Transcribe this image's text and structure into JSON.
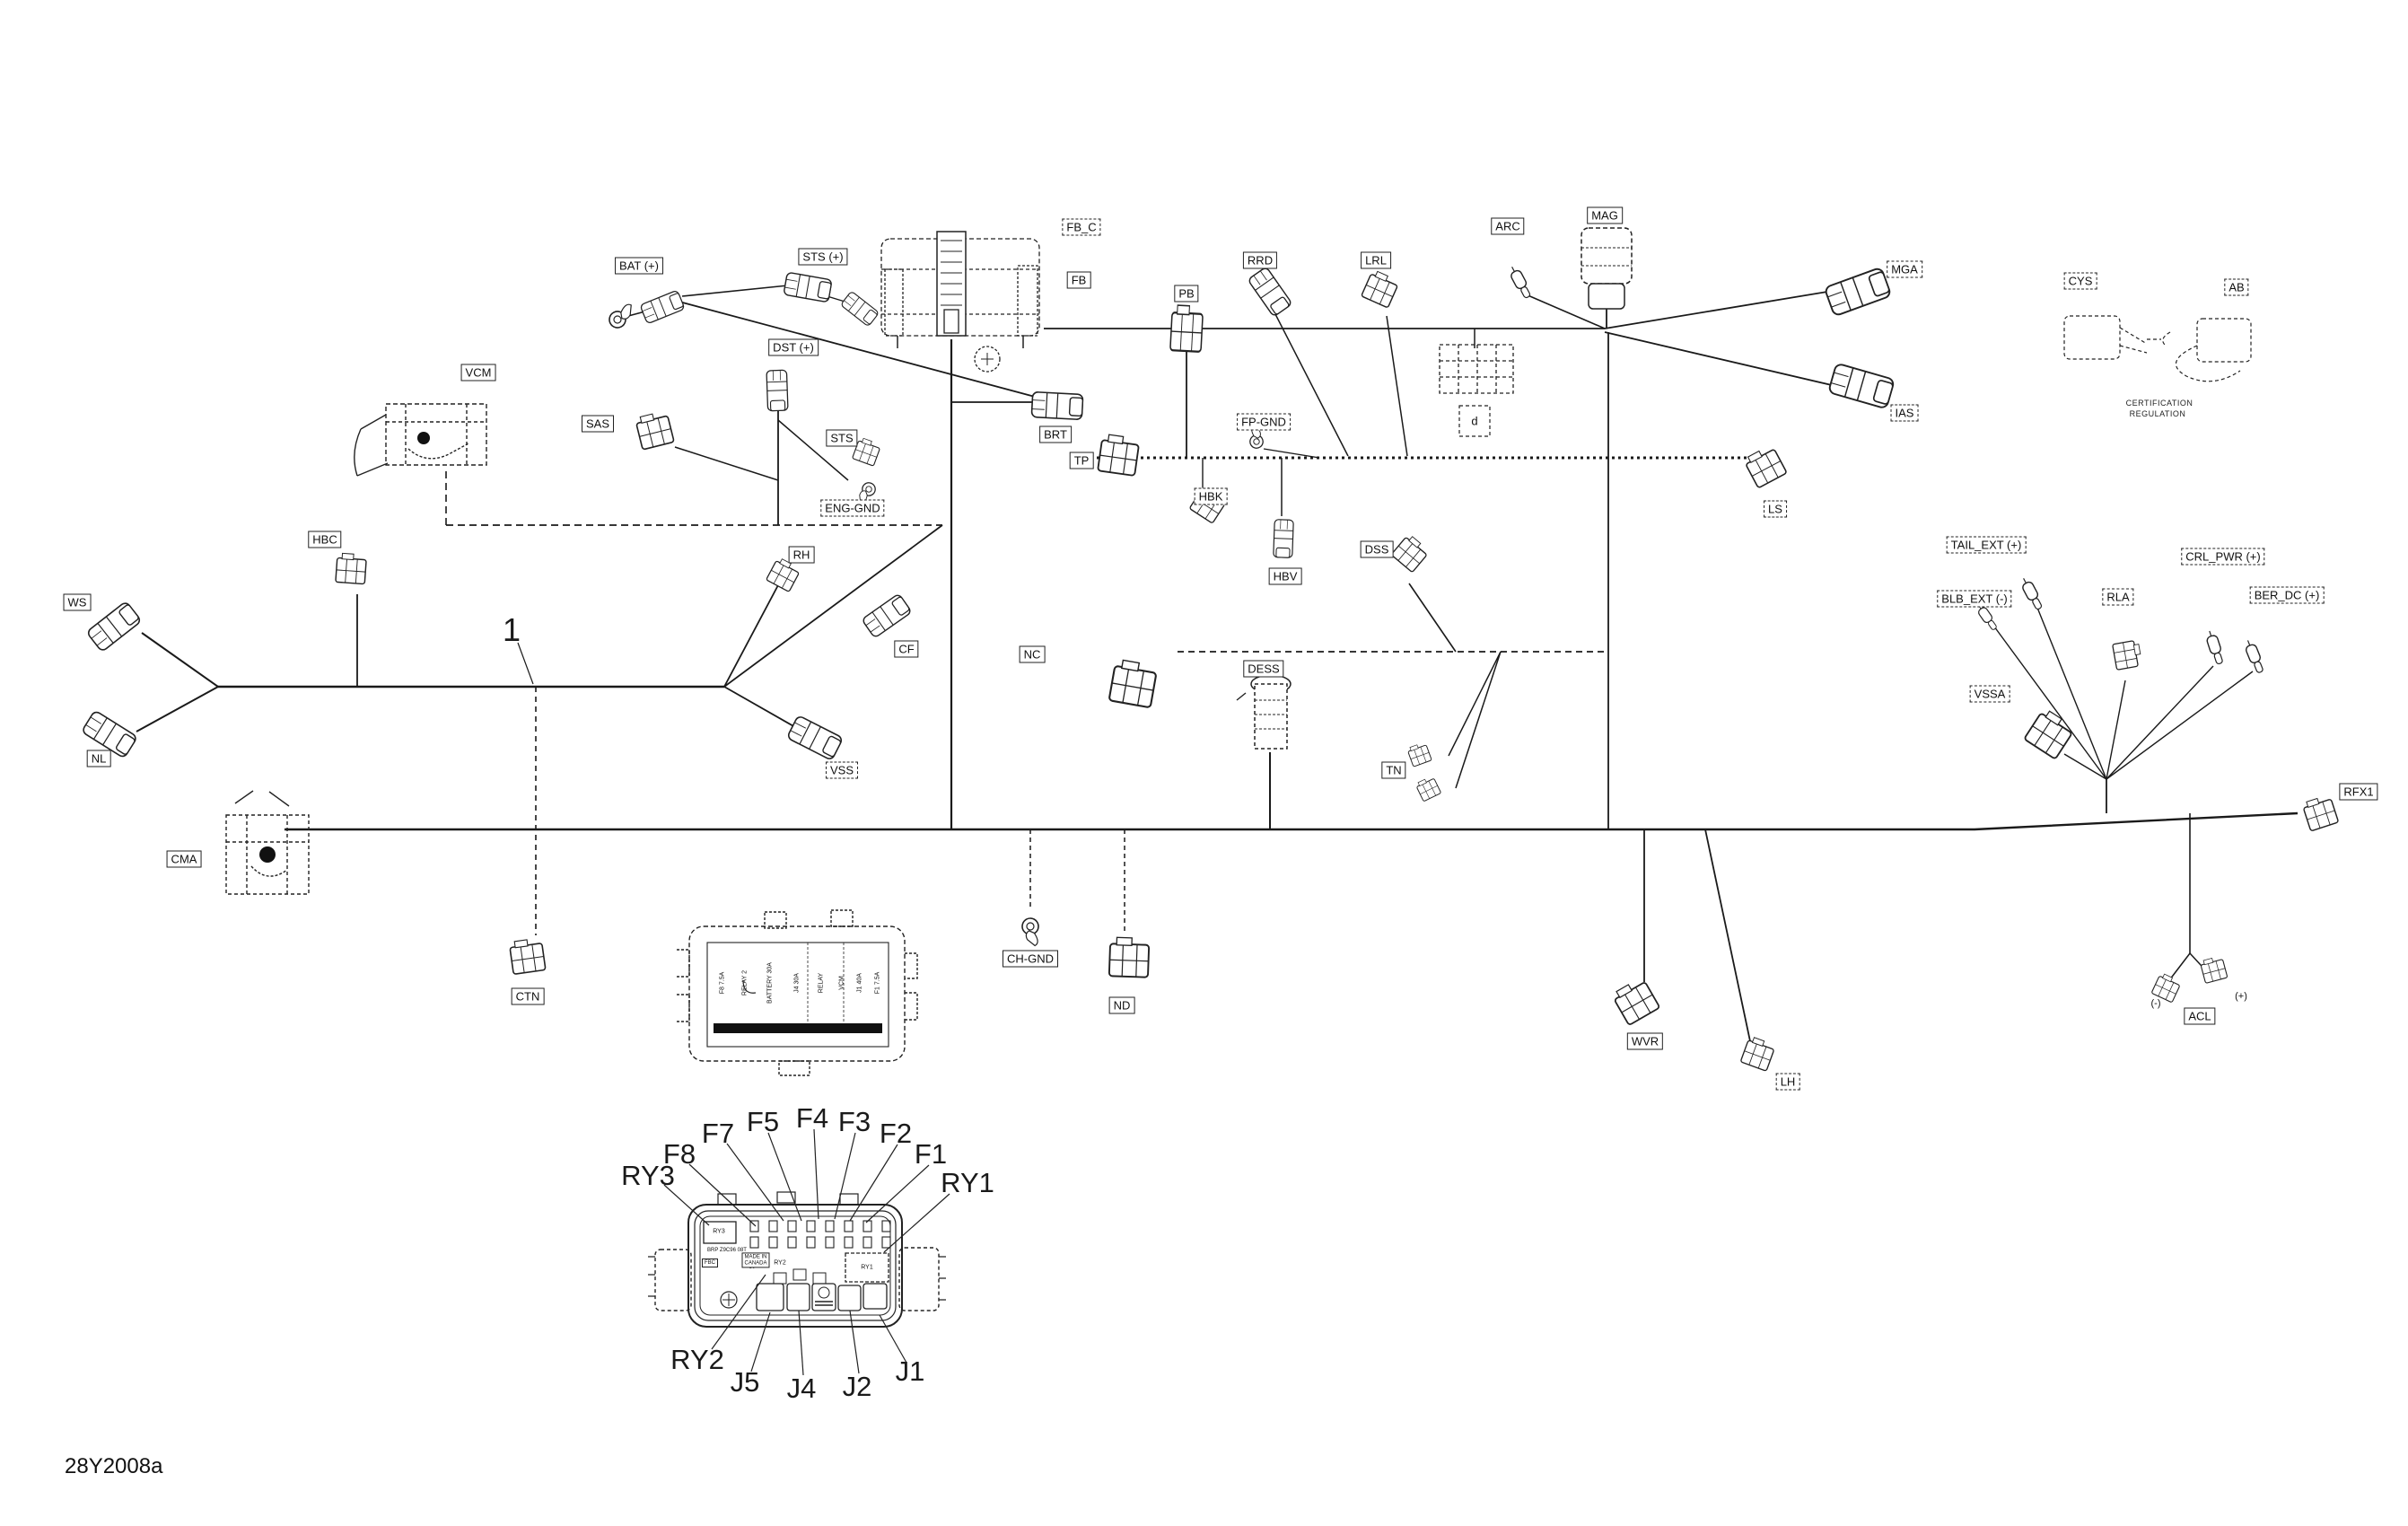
{
  "page": {
    "drawing_code": "28Y2008a",
    "figure_number": "1"
  },
  "labels": {
    "ws": {
      "text": "WS"
    },
    "nl": {
      "text": "NL"
    },
    "hbc": {
      "text": "HBC"
    },
    "cma": {
      "text": "CMA"
    },
    "ctn": {
      "text": "CTN"
    },
    "vcm": {
      "text": "VCM"
    },
    "sas": {
      "text": "SAS"
    },
    "bat_plus": {
      "text": "BAT (+)"
    },
    "sts_plus": {
      "text": "STS (+)"
    },
    "dst_plus": {
      "text": "DST (+)"
    },
    "sts": {
      "text": "STS"
    },
    "eng_gnd": {
      "text": "ENG-GND"
    },
    "fb_c": {
      "text": "FB_C"
    },
    "fb": {
      "text": "FB"
    },
    "rh": {
      "text": "RH"
    },
    "cf": {
      "text": "CF"
    },
    "vss": {
      "text": "VSS"
    },
    "brt": {
      "text": "BRT"
    },
    "tp": {
      "text": "TP"
    },
    "pb": {
      "text": "PB"
    },
    "rrd": {
      "text": "RRD"
    },
    "lrl": {
      "text": "LRL"
    },
    "fp_gnd": {
      "text": "FP-GND"
    },
    "hbk": {
      "text": "HBK"
    },
    "hbv": {
      "text": "HBV"
    },
    "dss": {
      "text": "DSS"
    },
    "nc": {
      "text": "NC"
    },
    "dess": {
      "text": "DESS"
    },
    "tn": {
      "text": "TN"
    },
    "ch_gnd": {
      "text": "CH-GND"
    },
    "nd": {
      "text": "ND"
    },
    "arc": {
      "text": "ARC"
    },
    "mag": {
      "text": "MAG"
    },
    "mga": {
      "text": "MGA"
    },
    "ias": {
      "text": "IAS"
    },
    "ls": {
      "text": "LS"
    },
    "d_legend": {
      "text": "d"
    },
    "wvr": {
      "text": "WVR"
    },
    "lh": {
      "text": "LH"
    },
    "tail_ext": {
      "text": "TAIL_EXT (+)"
    },
    "blb_ext": {
      "text": "BLB_EXT (-)"
    },
    "rla": {
      "text": "RLA"
    },
    "vssa": {
      "text": "VSSA"
    },
    "crl_pwr": {
      "text": "CRL_PWR (+)"
    },
    "ber_dc": {
      "text": "BER_DC (+)"
    },
    "acl": {
      "text": "ACL"
    },
    "rfx1": {
      "text": "RFX1"
    },
    "cys": {
      "text": "CYS"
    },
    "ab": {
      "text": "AB"
    }
  },
  "marks": {
    "acl_minus": "(-)",
    "acl_plus": "(+)"
  },
  "note": {
    "line1": "CERTIFICATION",
    "line2": "REGULATION"
  },
  "fusebox_detail": {
    "callouts": {
      "ry3": "RY3",
      "f8": "F8",
      "f7": "F7",
      "f5": "F5",
      "f4": "F4",
      "f3": "F3",
      "f2": "F2",
      "f1": "F1",
      "ry1": "RY1",
      "ry2": "RY2",
      "j5": "J5",
      "j4": "J4",
      "j2": "J2",
      "j1": "J1"
    },
    "internal": {
      "ry1": "RY1",
      "ry2": "RY2",
      "ry3": "RY3",
      "made_in": "MADE IN",
      "canada": "CANADA",
      "part_line": "BRP Z9C96 08T",
      "fbc": "FBC",
      "pin30": "30"
    }
  },
  "fusebox_lid": {
    "print_columns": [
      "F8 7.5A",
      "RELAY 2",
      "BATTERY 30A",
      "J4 30A",
      "RELAY",
      "VCM",
      "J1 40A",
      "F1 7.5A"
    ]
  }
}
